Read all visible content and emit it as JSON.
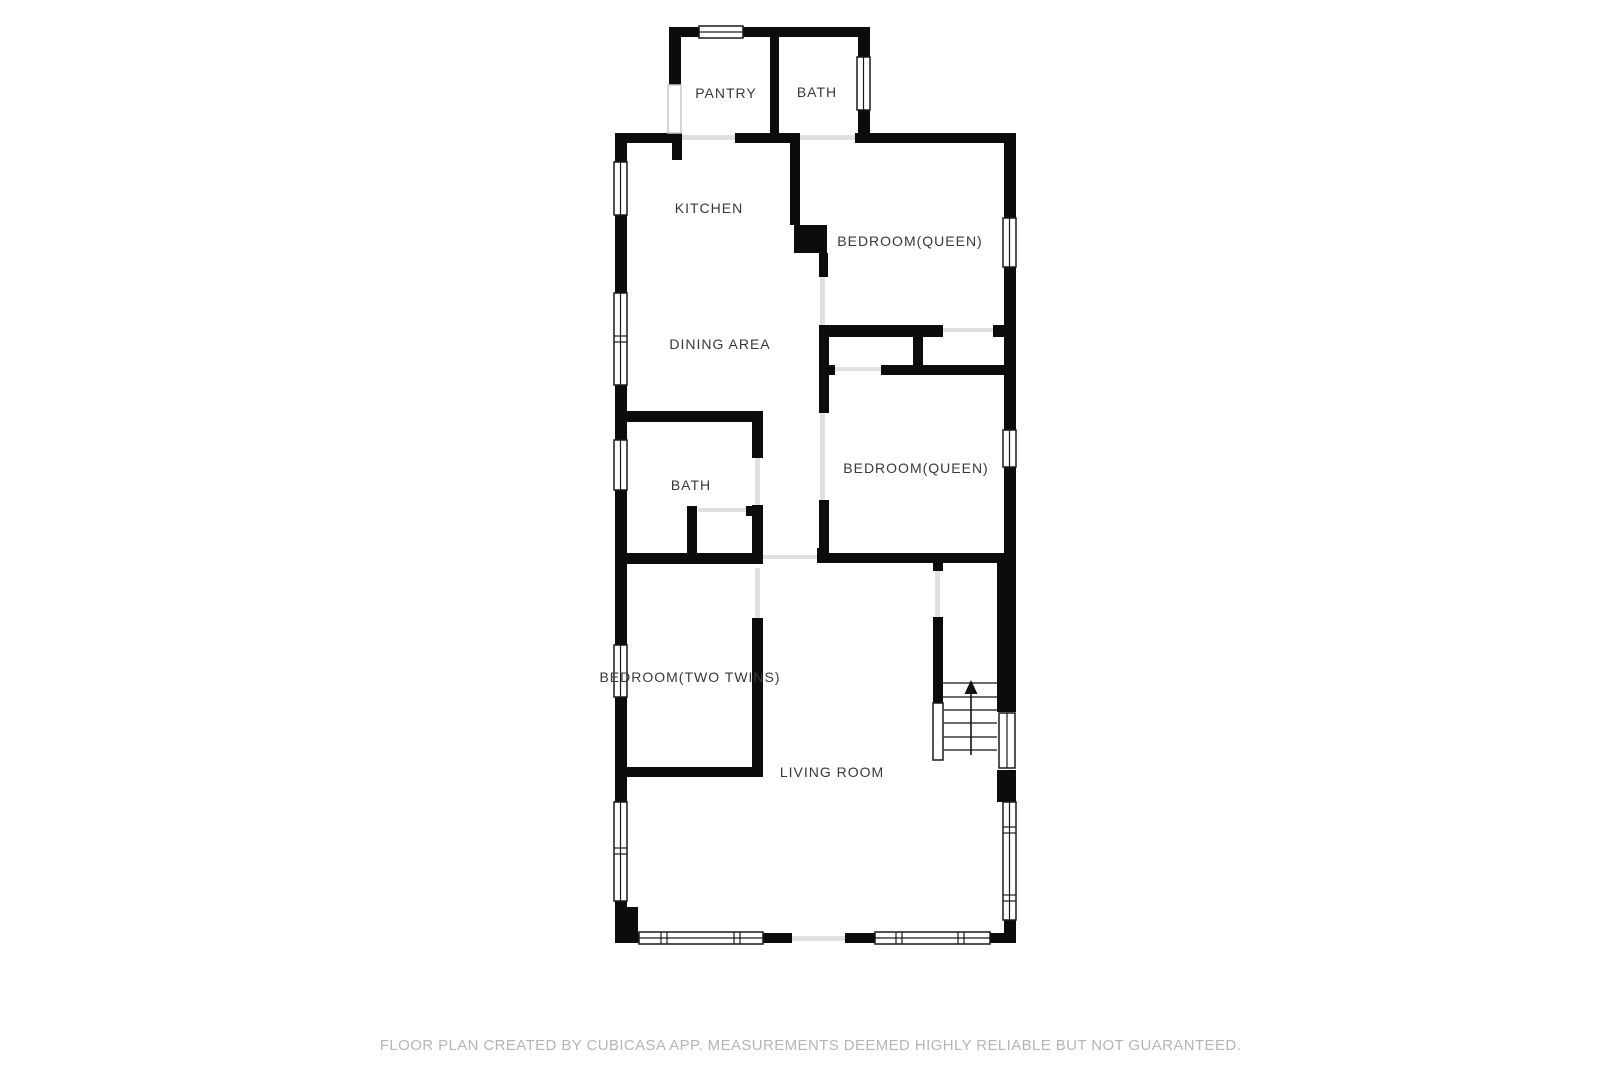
{
  "floor_plan": {
    "rooms": {
      "pantry": {
        "label": "PANTRY"
      },
      "bath_top": {
        "label": "BATH"
      },
      "kitchen": {
        "label": "KITCHEN"
      },
      "bedroom_upper": {
        "label": "BEDROOM(QUEEN)"
      },
      "dining": {
        "label": "DINING AREA"
      },
      "bath_middle": {
        "label": "BATH"
      },
      "bedroom_lower": {
        "label": "BEDROOM(QUEEN)"
      },
      "bedroom_twins": {
        "label": "BEDROOM(TWO TWINS)"
      },
      "living": {
        "label": "LIVING ROOM"
      }
    },
    "stairs": {
      "direction": "up"
    },
    "footer": {
      "text": "FLOOR PLAN CREATED BY CUBICASA APP. MEASUREMENTS DEEMED HIGHLY RELIABLE BUT NOT GUARANTEED."
    },
    "colors": {
      "wall": "#0c0c0c",
      "window_frame": "#1a1a1a",
      "threshold": "#e0e0e0",
      "label_text": "#383838",
      "footer_text": "#b5b5b5",
      "background": "#ffffff"
    }
  }
}
